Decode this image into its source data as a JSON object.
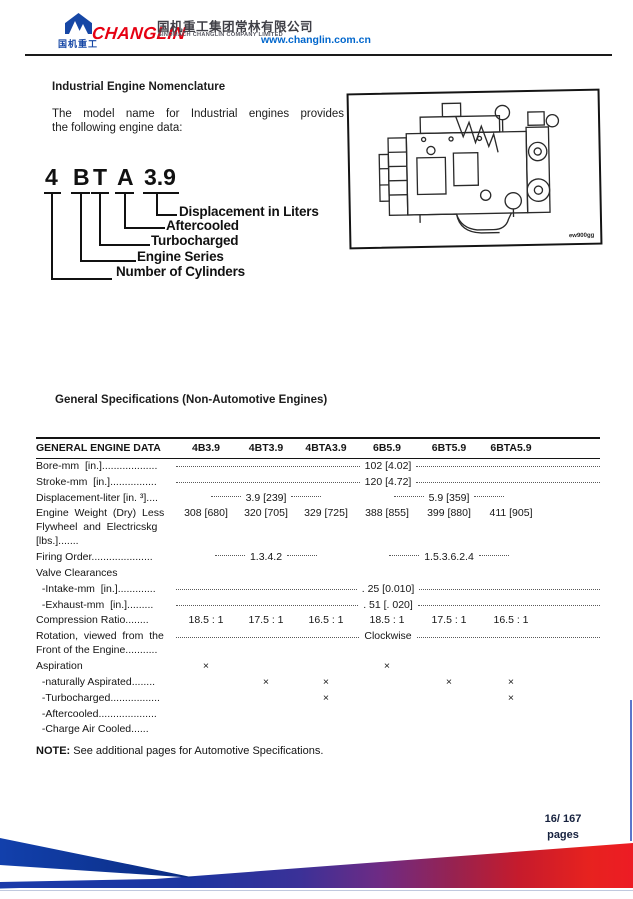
{
  "header": {
    "logo_text_cn": "国机重工",
    "brand": "CHANGLIN",
    "company_cn": "国机重工集团常林有限公司",
    "company_en": "SINOMACH CHANGLIN COMPANY LIMITED",
    "website": "www.changlin.com.cn",
    "brand_color": "#e60012",
    "logo_blue": "#1647a5",
    "link_blue": "#0066cc"
  },
  "nomenclature": {
    "title": "Industrial Engine Nomenclature",
    "intro_line1": "The model name for Industrial engines provides",
    "intro_line2": "the following engine data:",
    "model_parts": [
      "4",
      "B",
      "T",
      "A",
      "3.9"
    ],
    "labels": [
      "Displacement in Liters",
      "Aftercooled",
      "Turbocharged",
      "Engine Series",
      "Number of Cylinders"
    ],
    "figure_code": "ew900gg"
  },
  "specs_section": {
    "title": "General Specifications (Non-Automotive Engines)"
  },
  "table": {
    "headers": [
      "GENERAL ENGINE DATA",
      "4B3.9",
      "4BT3.9",
      "4BTA3.9",
      "6B5.9",
      "6BT5.9",
      "6BTA5.9"
    ],
    "rows": [
      {
        "type": "span-all",
        "label": "Bore-mm  [in.]...................",
        "value": "102 [4.02]"
      },
      {
        "type": "span-all",
        "label": "Stroke-mm  [in.]................",
        "value": "120 [4.72]"
      },
      {
        "type": "span-half",
        "label": "Displacement-liter [in. ³]....",
        "left": "3.9 [239]",
        "right": "5.9 [359]"
      },
      {
        "type": "cols",
        "bottom": true,
        "label": "Engine  Weight  (Dry)  Less\nFlywheel  and  Electricskg\n[lbs.].......",
        "values": [
          "308 [680]",
          "320 [705]",
          "329 [725]",
          "388 [855]",
          "399 [880]",
          "411 [905]"
        ]
      },
      {
        "type": "span-half",
        "label": "Firing Order.....................",
        "left": "1.3.4.2",
        "right": "1.5.3.6.2.4"
      },
      {
        "type": "label-only",
        "label": "Valve Clearances"
      },
      {
        "type": "span-all",
        "label": "  -Intake-mm  [in.].............",
        "value": ". 25 [0.010]"
      },
      {
        "type": "span-all",
        "label": "  -Exhaust-mm  [in.].........",
        "value": ". 51 [. 020]"
      },
      {
        "type": "cols",
        "label": "Compression Ratio........",
        "values": [
          "18.5 : 1",
          "17.5 : 1",
          "16.5 : 1",
          "18.5 : 1",
          "17.5 : 1",
          "16.5 : 1"
        ]
      },
      {
        "type": "span-all",
        "valign": "bottom",
        "label": "Rotation,  viewed  from  the\nFront of the Engine...........",
        "value": "Clockwise"
      },
      {
        "type": "cols",
        "label": "Aspiration",
        "values": [
          "×",
          "",
          "",
          "×",
          "",
          ""
        ]
      },
      {
        "type": "cols",
        "label": "  -naturally Aspirated........",
        "values": [
          "",
          "×",
          "×",
          "",
          "×",
          "×"
        ]
      },
      {
        "type": "cols",
        "label": "  -Turbocharged.................",
        "values": [
          "",
          "",
          "×",
          "",
          "",
          "×"
        ]
      },
      {
        "type": "cols",
        "label": "  -Aftercooled....................",
        "values": [
          "",
          "",
          "",
          "",
          "",
          ""
        ]
      },
      {
        "type": "cols",
        "label": "  -Charge Air Cooled......",
        "values": [
          "",
          "",
          "",
          "",
          "",
          ""
        ]
      }
    ]
  },
  "note": {
    "label": "NOTE:",
    "text": " See additional pages for Automotive Specifications."
  },
  "footer": {
    "page_number": "16/ 167",
    "pages_label": "pages",
    "band_colors": [
      "#1b3baa",
      "#6e2b84",
      "#e8231f"
    ]
  }
}
